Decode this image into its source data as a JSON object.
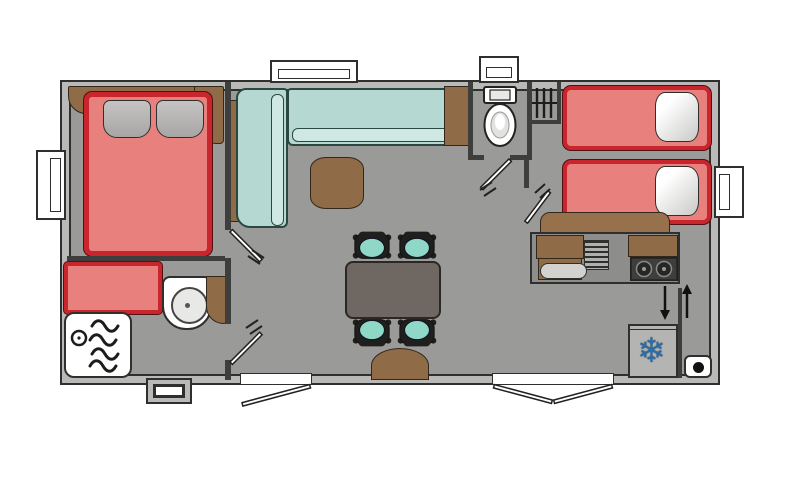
{
  "app": {
    "type": "floor-plan-drawing",
    "subject": "mobile-home top-down layout",
    "visible_text": "none"
  },
  "palette": {
    "background": "#ffffff",
    "floor": "#9a9a98",
    "wall_fill": "#b9b9b7",
    "wall_line": "#2f2f2d",
    "bed_fill": "#e8817d",
    "bed_frame_red": "#c9252c",
    "pillow_gray": "#b5b3b1",
    "pillow_white": "#efefed",
    "sofa_mint": "#b5d9d2",
    "sofa_edge": "#2a4741",
    "chair_seat_mint": "#8fd8c8",
    "wood_brown": "#8f6b48",
    "dining_table_top": "#6f6761",
    "hob_dark": "#3e3e3c",
    "snowflake_blue": "#2d6da6"
  },
  "symbols": {
    "snowflake_char": "❄"
  },
  "rooms": {
    "master_bedroom": {
      "position": "left",
      "furniture": [
        "double-bed",
        "gray-pillow x2",
        "headboard-shelf",
        "corner-cabinet"
      ]
    },
    "bathroom": {
      "position": "bottom-left",
      "furniture": [
        "red-bench",
        "washbasin",
        "corner-shelf",
        "shower-tray-with-drain-and-waves"
      ]
    },
    "living_area": {
      "position": "center",
      "furniture": [
        "l-shaped-corner-sofa",
        "coffee-table",
        "dining-table",
        "chair x4",
        "entry-step-arch"
      ]
    },
    "wc": {
      "position": "top-center-right",
      "furniture": [
        "toilet-with-cistern",
        "rail-closet"
      ]
    },
    "twin_bedroom": {
      "position": "right",
      "furniture": [
        "single-bed x2",
        "white-pillow x2",
        "desk-counter"
      ]
    },
    "kitchen": {
      "position": "center-right",
      "furniture": [
        "worktop",
        "sink",
        "drainer-rack",
        "two-burner-hob",
        "wood-cabinets"
      ]
    },
    "entrance": {
      "position": "bottom-right",
      "features": [
        "down-arrow",
        "up-arrow",
        "double-exterior-door"
      ]
    },
    "appliances": [
      "fridge-with-snowflake",
      "heater-box-with-dot"
    ]
  },
  "openings": {
    "windows": [
      "left-wall",
      "top-wall-living",
      "top-wall-wc",
      "right-wall",
      "bottom-wall-small-dark"
    ],
    "exterior_doors": [
      "bottom-single-door",
      "bottom-double-door"
    ],
    "interior_doors": [
      "master-bedroom-door",
      "bathroom-door",
      "wc-door",
      "twin-bedroom-door"
    ]
  },
  "counts": {
    "chairs": 4,
    "beds": 3,
    "hob_burners": 2,
    "wave_lines_in_shower": 4
  }
}
